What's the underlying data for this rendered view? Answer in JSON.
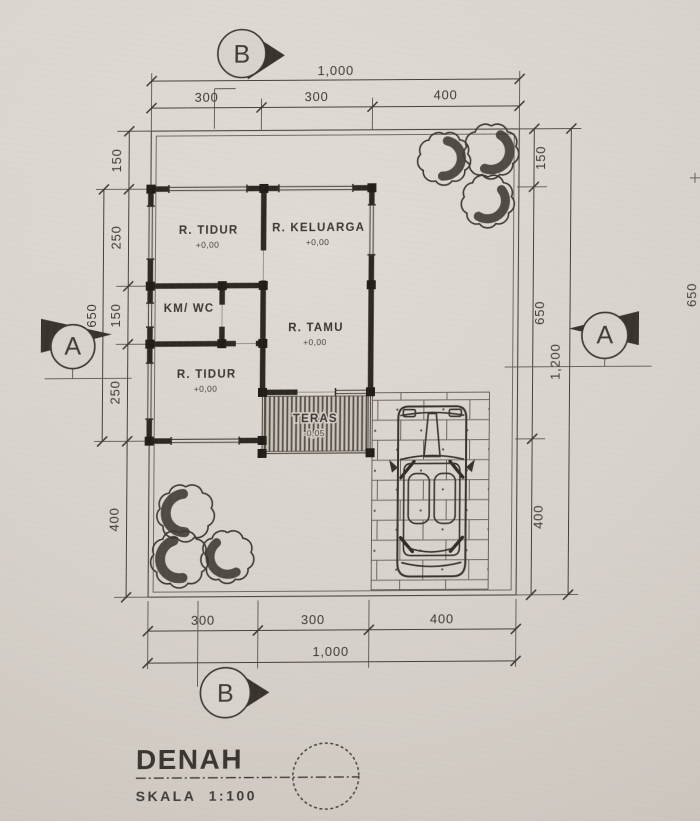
{
  "document": {
    "type_label": "DENAH",
    "scale_label": "SKALA",
    "scale_value": "1:100"
  },
  "section_markers": {
    "top": "B",
    "bottom": "B",
    "left": "A",
    "right": "A"
  },
  "dims": {
    "top_overall": "1,000",
    "top_seg1": "300",
    "top_seg2": "300",
    "top_seg3": "400",
    "bottom_seg1": "300",
    "bottom_seg2": "300",
    "bottom_seg3": "400",
    "bottom_overall": "1,000",
    "left_seg1": "150",
    "left_seg2": "250",
    "left_seg3": "150",
    "left_seg4": "250",
    "left_seg5": "400",
    "left_house_depth": "650",
    "right_seg1": "150",
    "right_seg2": "650",
    "right_seg3": "400",
    "right_overall": "1,200",
    "right_edge": "650"
  },
  "rooms": {
    "tidur1": {
      "name": "R. TIDUR",
      "level": "+0,00"
    },
    "keluarga": {
      "name": "R. KELUARGA",
      "level": "+0,00"
    },
    "kmwc": {
      "name": "KM/ WC"
    },
    "tamu": {
      "name": "R. TAMU",
      "level": "+0,00"
    },
    "tidur2": {
      "name": "R. TIDUR",
      "level": "+0,00"
    },
    "teras": {
      "name": "TERAS",
      "level": "-0,05"
    }
  },
  "colors": {
    "paper": "#d7d2cb",
    "ink": "#3c3833",
    "wall": "#2b2722"
  }
}
